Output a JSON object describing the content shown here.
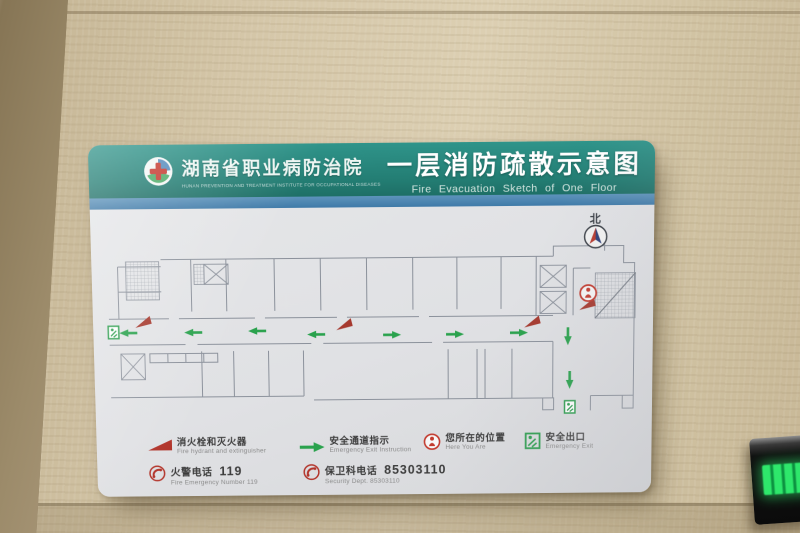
{
  "scene": {
    "wall_base_color": "#d0c2a2",
    "wall_column_color": "#9c8b6a",
    "led_display": {
      "panel_color": "#0b0b0b",
      "glow_color": "#2ee76b"
    }
  },
  "sign": {
    "board_color": "#e2e3e5",
    "header": {
      "teal_color": "#247e74",
      "stripe_color": "#3f7aa8",
      "logo": {
        "ring_color": "#ffffff",
        "cross_color": "#c5372e",
        "leaf_color": "#2e9e4f",
        "circle_color": "#2a6fae"
      },
      "org_name_cn": "湖南省职业病防治院",
      "org_name_en": "HUNAN PREVENTION AND TREATMENT INSTITUTE FOR OCCUPATIONAL DISEASES",
      "title_cn": "一层消防疏散示意图",
      "title_en": "Fire Evacuation Sketch of One Floor"
    },
    "map": {
      "north_label": "北",
      "line_color": "#8b919b",
      "arrow_color": "#2aa24d",
      "hydrant_color": "#a6392e",
      "exit_color": "#2e9e4f",
      "here_color": "#c23a2e",
      "compass": {
        "x": 488,
        "y": 29
      },
      "you_are_here": {
        "x": 481,
        "y": 85
      },
      "arrows": [
        {
          "dir": "left",
          "x": 21,
          "y": 121
        },
        {
          "dir": "left",
          "x": 86,
          "y": 121
        },
        {
          "dir": "left",
          "x": 150,
          "y": 120
        },
        {
          "dir": "left",
          "x": 209,
          "y": 124
        },
        {
          "dir": "right",
          "x": 285,
          "y": 125
        },
        {
          "dir": "right",
          "x": 348,
          "y": 125
        },
        {
          "dir": "right",
          "x": 412,
          "y": 124
        },
        {
          "dir": "down",
          "x": 461,
          "y": 128
        },
        {
          "dir": "down",
          "x": 463,
          "y": 172
        }
      ],
      "hydrants": [
        {
          "x": 35,
          "y": 110
        },
        {
          "x": 236,
          "y": 114
        },
        {
          "x": 424,
          "y": 113
        },
        {
          "x": 479,
          "y": 96
        }
      ],
      "exits": [
        {
          "x": 1,
          "y": 114
        },
        {
          "x": 458,
          "y": 193
        }
      ]
    },
    "legend": [
      {
        "icon": "fire-hydrant-icon",
        "cn": "消火栓和灭火器",
        "en": "Fire hydrant and extinguisher"
      },
      {
        "icon": "exit-route-arrow-icon",
        "cn": "安全通道指示",
        "en": "Emergency Exit Instruction"
      },
      {
        "icon": "you-are-here-icon",
        "cn": "您所在的位置",
        "en": "Here You Are"
      },
      {
        "icon": "emergency-exit-icon",
        "cn": "安全出口",
        "en": "Emergency Exit"
      }
    ],
    "phones": [
      {
        "icon": "phone-icon",
        "cn": "火警电话",
        "number": "119",
        "en": "Fire Emergency Number 119"
      },
      {
        "icon": "phone-icon",
        "cn": "保卫科电话",
        "number": "85303110",
        "en": "Security Dept. 85303110"
      }
    ]
  }
}
